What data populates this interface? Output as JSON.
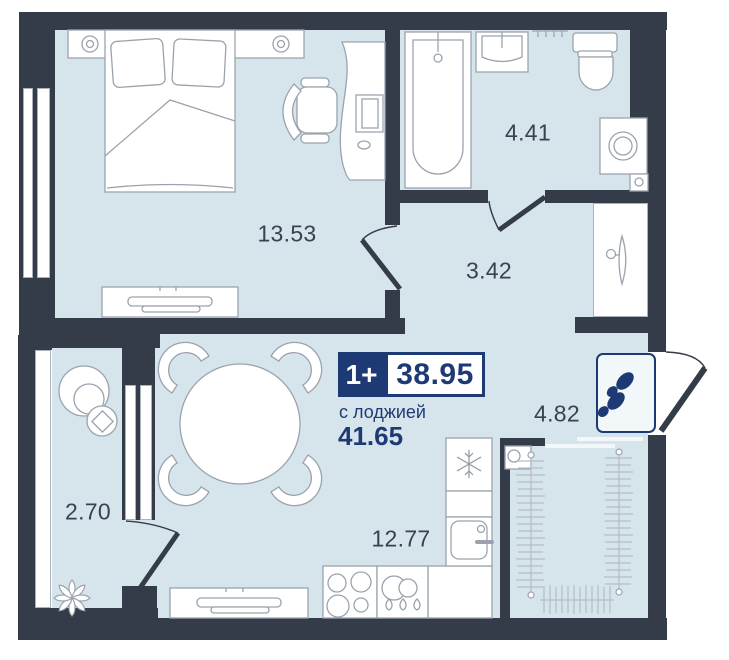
{
  "plan": {
    "unit": {
      "type_badge": "1+",
      "area_badge": "38.95",
      "subtitle": "с лоджией",
      "total_area": "41.65"
    },
    "rooms": [
      {
        "id": "bedroom",
        "area": "13.53"
      },
      {
        "id": "bathroom",
        "area": "4.41"
      },
      {
        "id": "hallway",
        "area": "3.42"
      },
      {
        "id": "entry",
        "area": "4.82"
      },
      {
        "id": "kitchen-living",
        "area": "12.77"
      },
      {
        "id": "loggia",
        "area": "2.70"
      }
    ],
    "colors": {
      "wall": "#343B49",
      "floor": "#D6E4EC",
      "accent": "#1E3A74",
      "room_label": "#3A4150"
    },
    "icons": {
      "doormat": "footprints-icon",
      "fridge": "snowflake-icon",
      "wardrobe": "hanger-icon"
    }
  }
}
